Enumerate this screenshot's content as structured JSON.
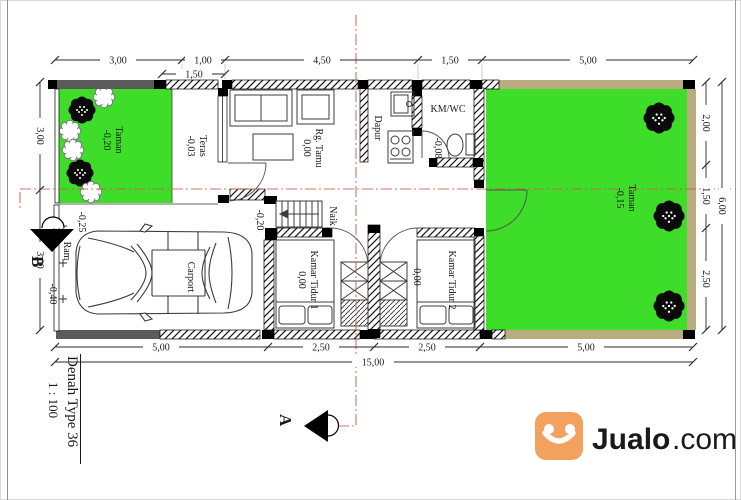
{
  "title": {
    "name": "Denah Type 36",
    "scale": "1 : 100"
  },
  "watermark": {
    "brand": "Jualo",
    "suffix": ".com"
  },
  "markers": {
    "a": "A",
    "b": "B"
  },
  "rooms": {
    "taman_left": {
      "label": "Taman",
      "level": "-0,20"
    },
    "teras": {
      "label": "Teras",
      "level": "-0,03"
    },
    "rg_tamu": {
      "label": "Rg. Tamu",
      "level": "0,00"
    },
    "dapur": {
      "label": "Dapur"
    },
    "km_wc": {
      "label": "KM/WC",
      "level": "-0,08"
    },
    "taman_right": {
      "label": "Taman",
      "level": "-0,15"
    },
    "carport": {
      "label": "Carport",
      "entry_level": "-0,20"
    },
    "ram": {
      "label": "Ram",
      "level": "-0,25"
    },
    "kamar_tidur_1": {
      "label": "Kamar Tidur 1",
      "level": "0,00"
    },
    "kamar_tidur_2": {
      "label": "Kamar Tidur 2",
      "level": "0,00"
    },
    "naik": {
      "label": "Naik"
    },
    "street": {
      "level": "-0,40"
    }
  },
  "dims": {
    "top": [
      "3,00",
      "1,00",
      "4,50",
      "1,50",
      "5,00"
    ],
    "top_sub": "1,50",
    "bottom": [
      "5,00",
      "2,50",
      "2,50",
      "5,00"
    ],
    "bottom_total": "15,00",
    "left": [
      "3,00",
      "3,00"
    ],
    "right": [
      "2,00",
      "1,50",
      "2,50"
    ],
    "right_total": "6,00"
  },
  "colors": {
    "grass": "#3edd2a",
    "wall_tan": "#b9ac7e",
    "wall_gray": "#5a5a5a",
    "centerline": "#c2614b",
    "brand_orange": "#f2a25e",
    "brand_orange_light": "#f6bd8e"
  }
}
